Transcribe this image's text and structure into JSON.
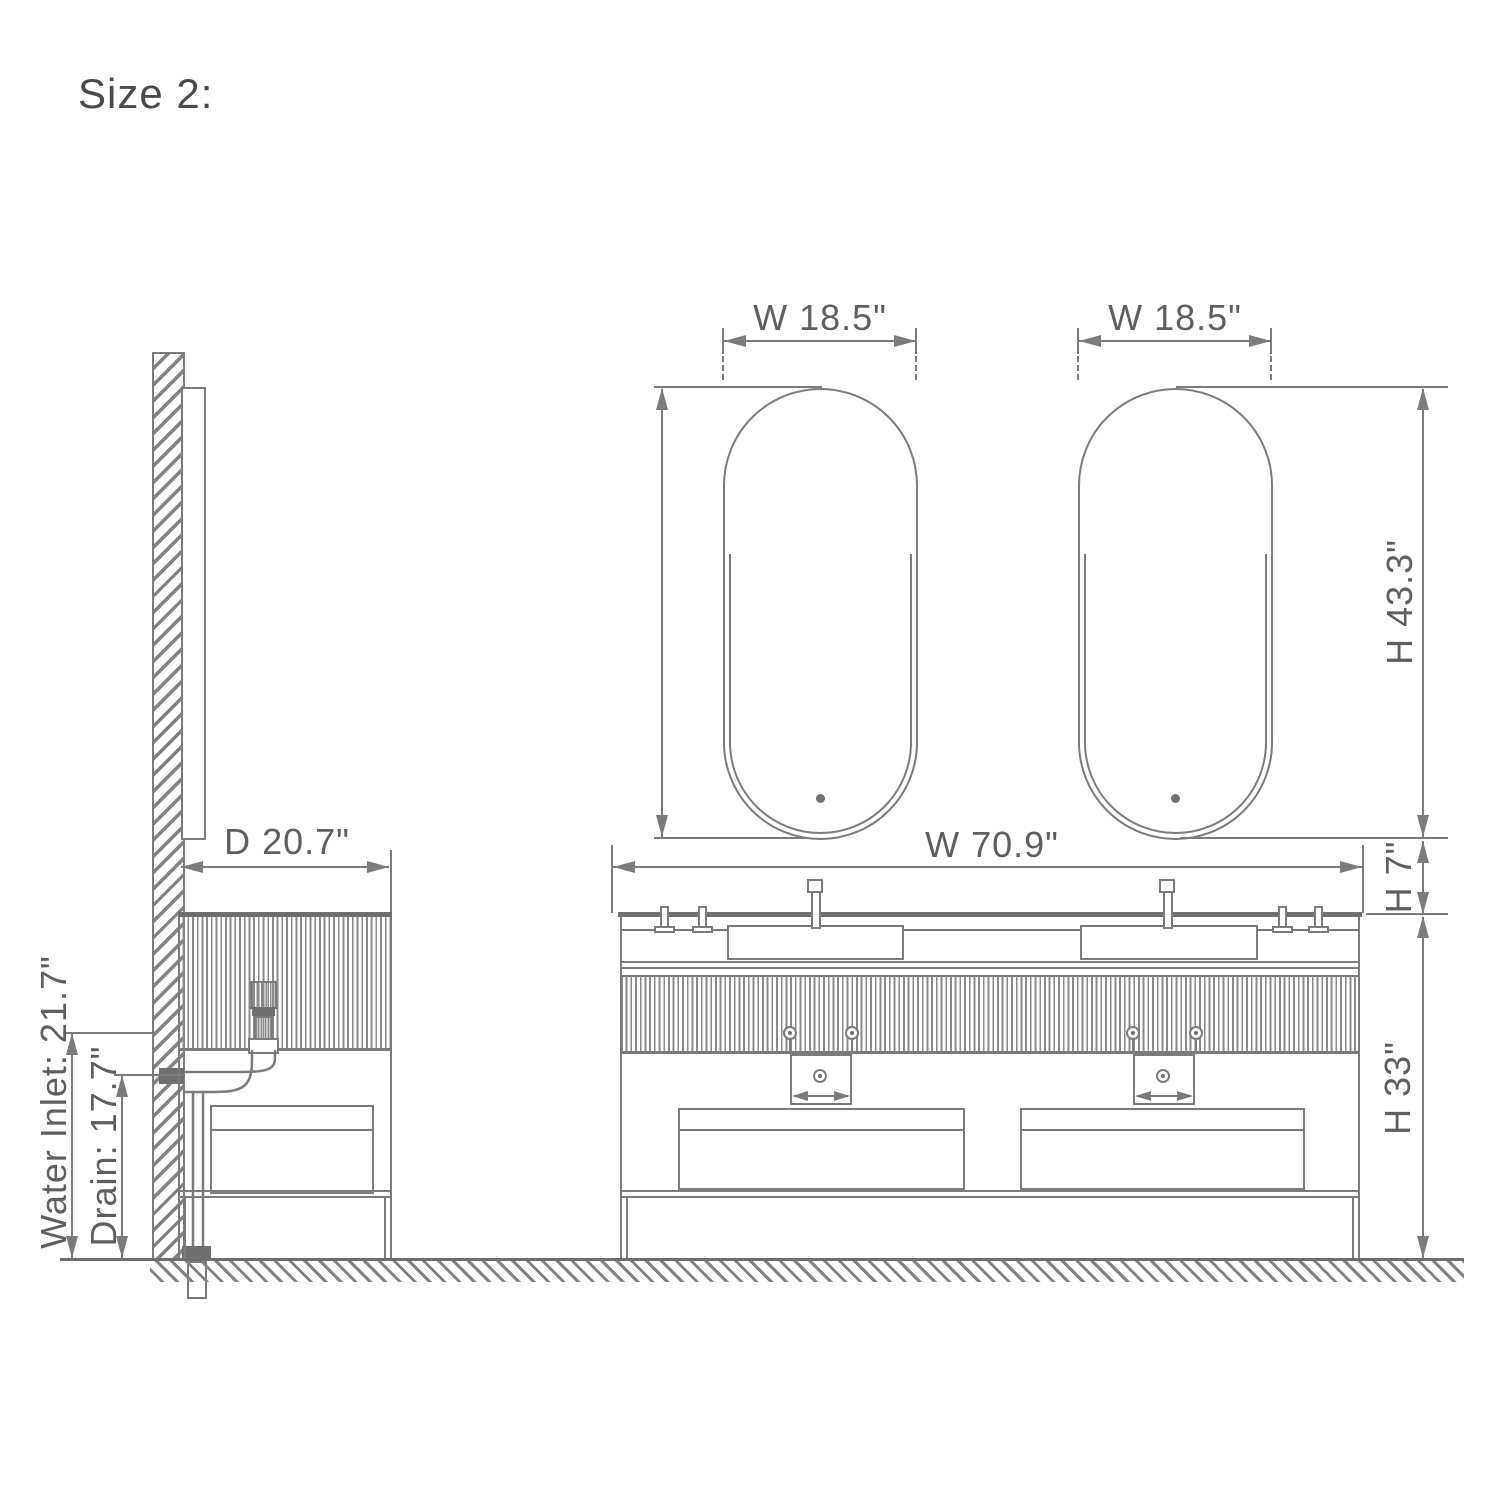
{
  "labels": {
    "title": "Size 2:",
    "mirror_left_width": "W 18.5\"",
    "mirror_right_width": "W 18.5\"",
    "mirror_height": "H 43.3\"",
    "vanity_width": "W 70.9\"",
    "countertop_height": "H 7\"",
    "cabinet_height": "H 33\"",
    "depth": "D 20.7\"",
    "water_inlet": "Water Inlet: 21.7\"",
    "drain": "Drain: 17.7\"",
    "left_drawer_gap": "5.9\"",
    "right_drawer_gap": "5.9\""
  },
  "colors": {
    "line": "#7b7b7b",
    "thick_line": "#6e6e6e",
    "text": "#5e5e5e",
    "dark_fill": "#6f6f6f",
    "title_text": "#4a4a4a",
    "background": "#ffffff"
  }
}
